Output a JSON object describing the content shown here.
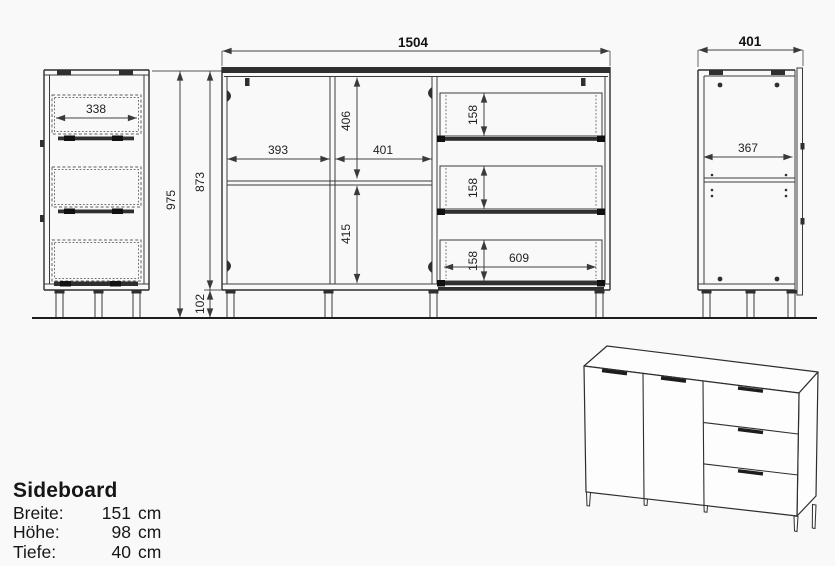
{
  "colors": {
    "background": "#f9f9f9",
    "line": "#3a3a3a",
    "dark_fill": "#2f2f2f",
    "text": "#161616"
  },
  "front_view": {
    "width": "1504",
    "door_left_width": "393",
    "door_right_width": "401",
    "upper_height": "406",
    "lower_height": "415",
    "drawer_width": "609",
    "drawers": [
      {
        "height": "158"
      },
      {
        "height": "158"
      },
      {
        "height": "158"
      }
    ],
    "body_height": "873",
    "leg_height": "102"
  },
  "side_view_left": {
    "total_height": "975",
    "drawer_depth": "338"
  },
  "side_view_right": {
    "width": "401",
    "interior_width": "367"
  },
  "title_block": {
    "title": "Sideboard",
    "specs": [
      {
        "label": "Breite:",
        "value": "151",
        "unit": "cm"
      },
      {
        "label": "Höhe:",
        "value": "98",
        "unit": "cm"
      },
      {
        "label": "Tiefe:",
        "value": "40",
        "unit": "cm"
      }
    ]
  }
}
